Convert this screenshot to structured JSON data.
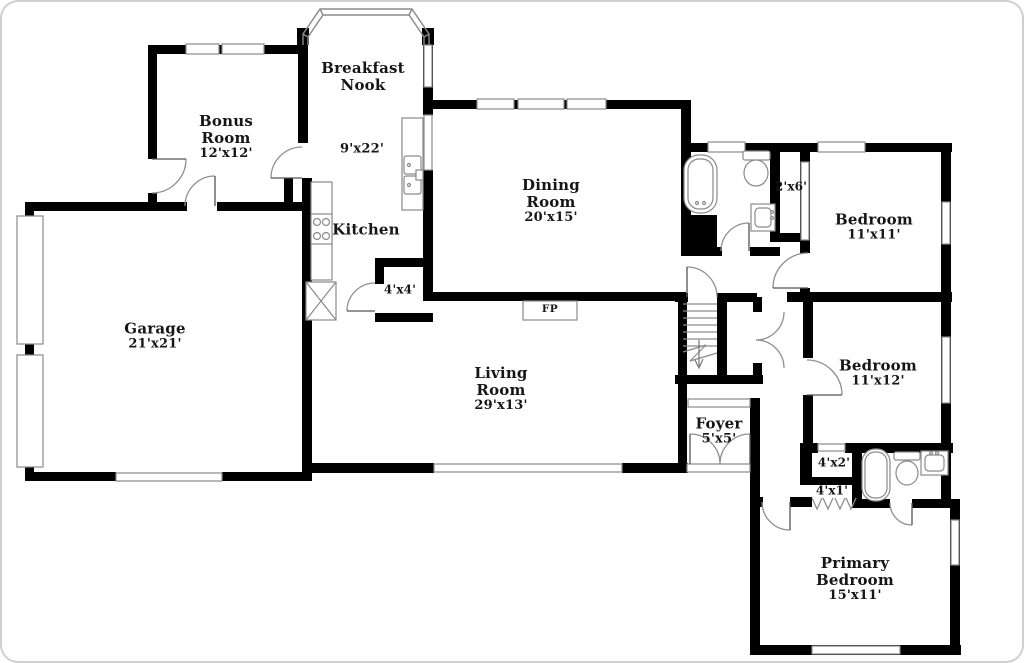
{
  "canvas": {
    "width": 1024,
    "height": 663,
    "background": "#ffffff",
    "wall_color": "#000000",
    "fixture_line_color": "#8a8a8a",
    "text_color": "#161616"
  },
  "rooms": {
    "breakfast_nook": {
      "line1": "Breakfast",
      "line2": "Nook",
      "dims": "9'x22'"
    },
    "bonus_room": {
      "line1": "Bonus",
      "line2": "Room",
      "dims": "12'x12'"
    },
    "dining_room": {
      "line1": "Dining",
      "line2": "Room",
      "dims": "20'x15'"
    },
    "kitchen": {
      "line1": "Kitchen"
    },
    "garage": {
      "line1": "Garage",
      "dims": "21'x21'"
    },
    "living_room": {
      "line1": "Living",
      "line2": "Room",
      "dims": "29'x13'"
    },
    "foyer": {
      "line1": "Foyer",
      "dims": "5'x5'"
    },
    "bedroom_top_right": {
      "line1": "Bedroom",
      "dims": "11'x11'"
    },
    "bedroom_mid_right": {
      "line1": "Bedroom",
      "dims": "11'x12'"
    },
    "primary_bedroom": {
      "line1": "Primary",
      "line2": "Bedroom",
      "dims": "15'x11'"
    }
  },
  "annotations": {
    "fireplace": "FP",
    "closet_4x4": "4'x4'",
    "closet_4x2": "4'x2'",
    "closet_4x1": "4'x1'",
    "hall_2x6": "2'x6'"
  }
}
